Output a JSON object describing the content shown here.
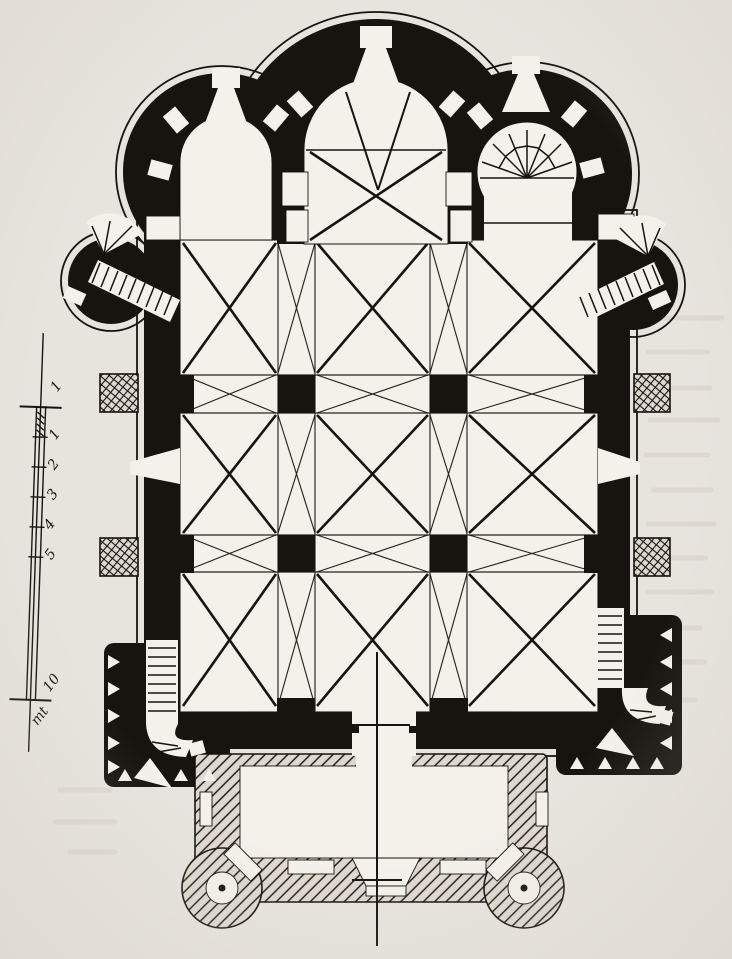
{
  "palette": {
    "paper": "#e7e4de",
    "room": "#f3f1ea",
    "ink": "#17130e",
    "hatchbg": "#ded9d0",
    "bleed": "#c2bcae"
  },
  "scale_bar": {
    "tick_labels": [
      "1",
      "1",
      "2",
      "3",
      "4",
      "5"
    ],
    "end_label": "10",
    "unit_label": "mt"
  }
}
